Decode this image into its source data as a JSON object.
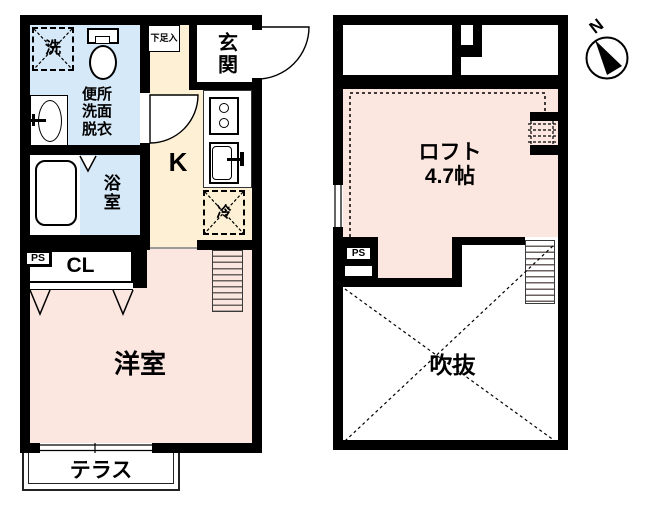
{
  "document_type": "japanese-apartment-floor-plan",
  "colors": {
    "water_area_blue": "#d6e9f8",
    "kitchen_cream": "#fdf0d5",
    "room_pink": "#fce6e0",
    "wall_black": "#000000",
    "stair_line": "#6b625f"
  },
  "floor1": {
    "labels": {
      "washing_machine": "洗",
      "sanitary_line1": "便所",
      "sanitary_line2": "洗面",
      "sanitary_line3": "脱衣",
      "bathroom": "浴室",
      "kitchen": "K",
      "entrance": "玄関",
      "shoe_cabinet": "下足入",
      "refrigerator": "冷",
      "pipe_space": "PS",
      "closet": "CL",
      "western_room": "洋室",
      "terrace": "テラス"
    }
  },
  "floor2": {
    "labels": {
      "loft": "ロフト",
      "loft_size": "4.7帖",
      "open_void": "吹抜",
      "pipe_space": "PS"
    }
  },
  "compass": {
    "north": "N"
  }
}
